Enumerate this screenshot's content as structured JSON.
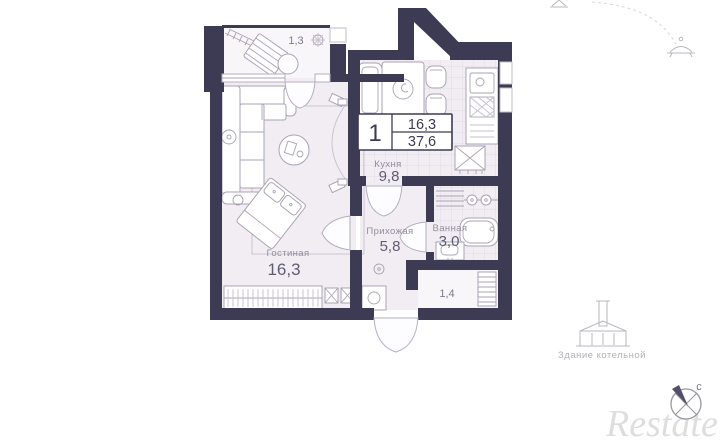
{
  "unit_card": {
    "rooms_count": "1",
    "living_area": "16,3",
    "total_area": "37,6"
  },
  "rooms": {
    "balcony_top": {
      "area": "1,3"
    },
    "living": {
      "name": "Гостиная",
      "area": "16,3"
    },
    "kitchen": {
      "name": "Кухня",
      "area": "9,8"
    },
    "hallway": {
      "name": "Прихожая",
      "area": "5,8"
    },
    "bathroom": {
      "name": "Ванная",
      "area": "3,0"
    },
    "loggia": {
      "area": "1,4"
    }
  },
  "annotations": {
    "boiler_building": "Здание котельной",
    "compass_north": "с",
    "watermark": "Restate"
  },
  "colors": {
    "wall": "#3c3b53",
    "floor": "#f2edf3",
    "floor_light": "#f9f6fa",
    "tile_grid": "#ddd5e0",
    "furniture_stroke": "#aaa3b5",
    "label_gray": "#928e9e",
    "number_dark": "#5f5d73",
    "outside_gray": "#b9b7c0",
    "watermark_gray": "#dedede"
  }
}
